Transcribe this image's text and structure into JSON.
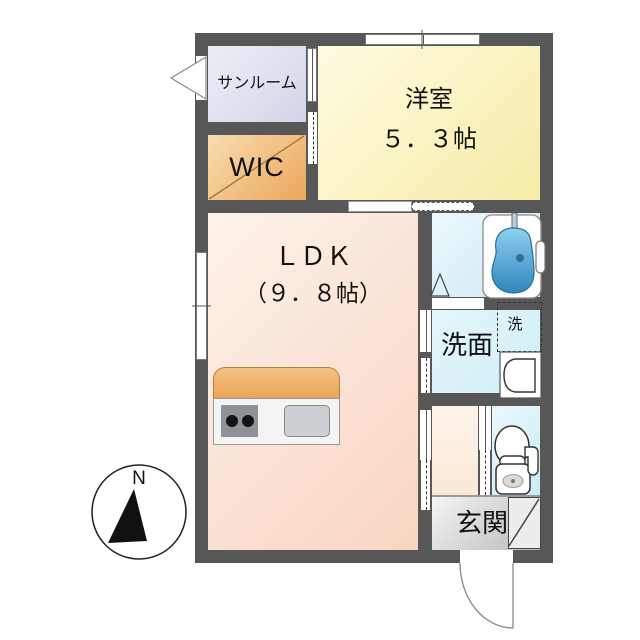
{
  "compass": {
    "north_label": "N"
  },
  "rooms": {
    "sunroom": {
      "label": "サンルーム"
    },
    "wic": {
      "label": "WIC"
    },
    "western_room": {
      "label": "洋室",
      "size": "５．３帖"
    },
    "ldk": {
      "label": "ＬＤＫ",
      "size": "（９．８帖）"
    },
    "washroom": {
      "label": "洗面"
    },
    "washer": {
      "label": "洗"
    },
    "entrance": {
      "label": "玄関"
    }
  },
  "colors": {
    "wall": "#575757",
    "sunroom": "#dde0ee",
    "wic": "#efb269",
    "western_room": "#f9f1b8",
    "ldk": "#fadfd0",
    "bath_floor": "#d7edf7",
    "washroom": "#d9f1f7",
    "toilet_room": "#d6f0f8",
    "hallway": "#fcf0e3",
    "entrance": "#d4d4d4",
    "bathtub": "#4d9fd0",
    "kitchen_counter": "#f0ac64"
  }
}
